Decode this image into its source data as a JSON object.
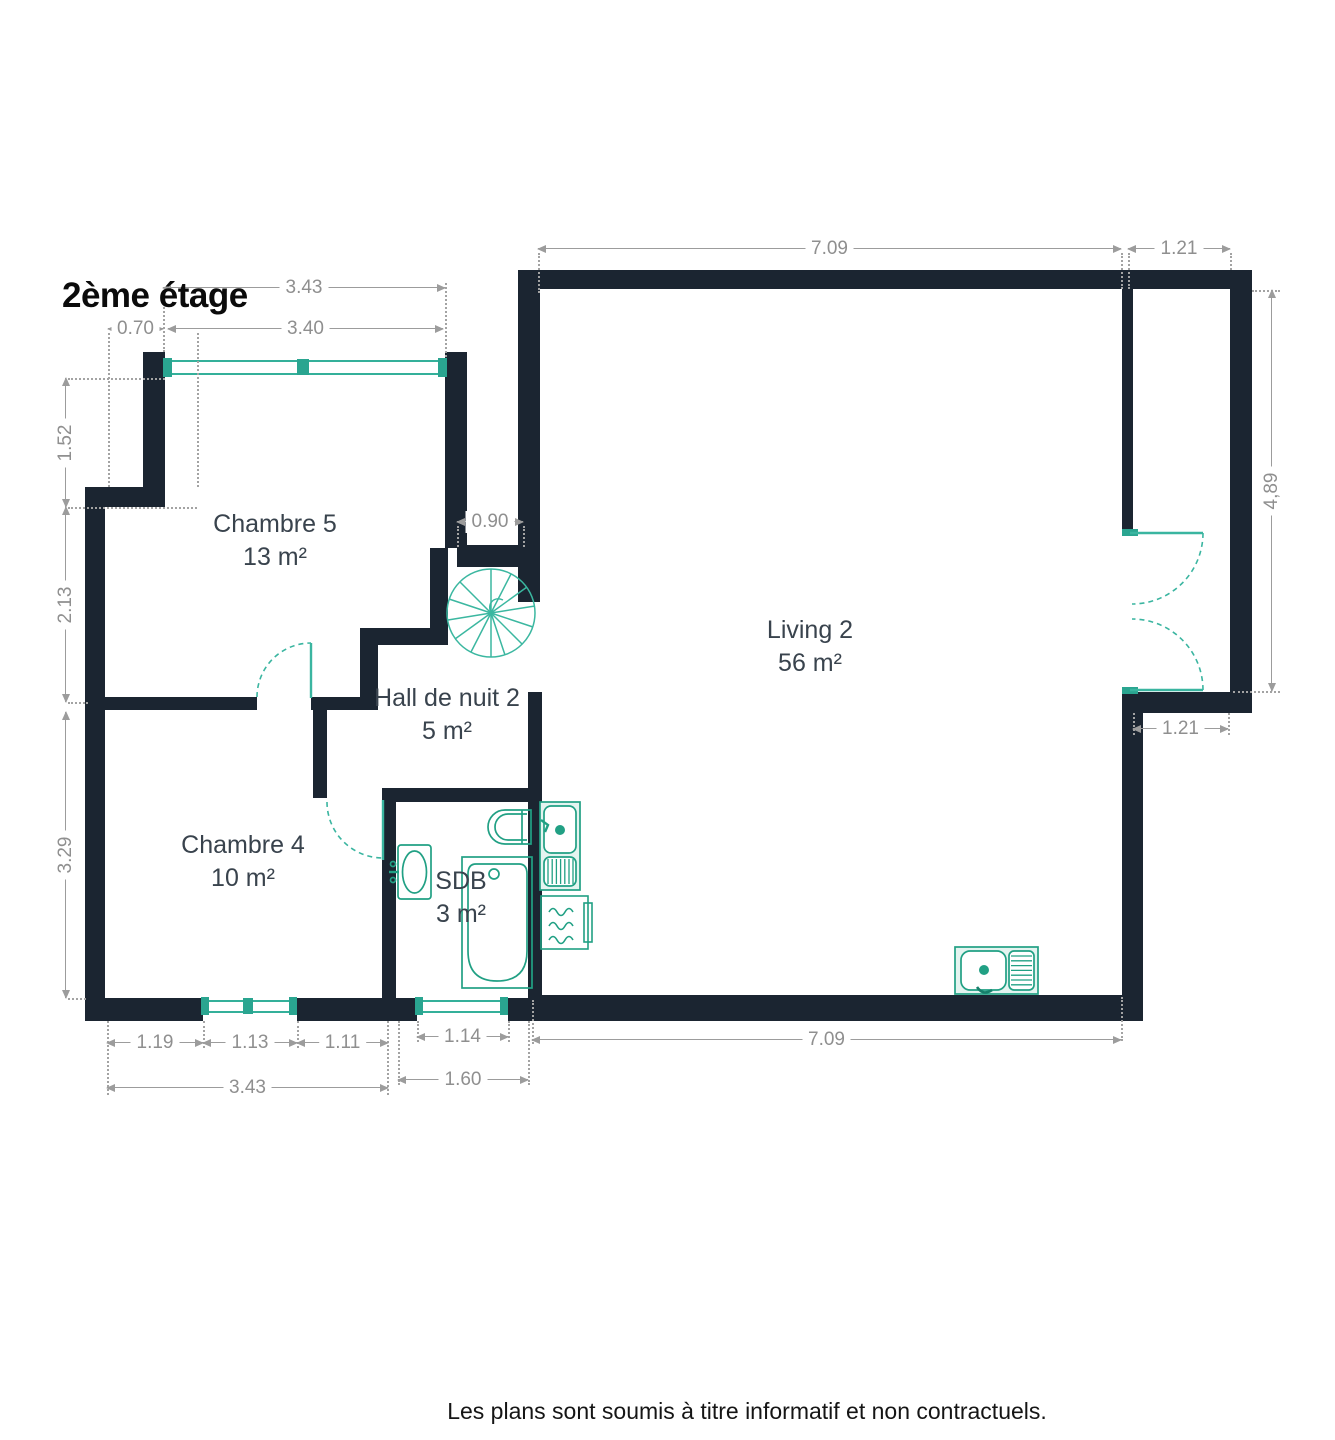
{
  "title": "2ème étage",
  "rooms": [
    {
      "name": "Chambre 5",
      "area": "13 m²"
    },
    {
      "name": "Living 2",
      "area": "56 m²"
    },
    {
      "name": "Hall de nuit 2",
      "area": "5 m²"
    },
    {
      "name": "Chambre 4",
      "area": "10 m²"
    },
    {
      "name": "SDB",
      "area": "3 m²"
    }
  ],
  "dims": {
    "c5_top_total": "3.43",
    "c5_top_offset": "0.70",
    "c5_top_window": "3.40",
    "left_upper": "1.52",
    "left_mid": "2.13",
    "left_lower": "3.29",
    "stair_width": "0.90",
    "living_top": "7.09",
    "balcony_top": "1.21",
    "living_right": "4,89",
    "balcony_inner": "1.21",
    "living_bottom": "7.09",
    "c4_seg1": "1.19",
    "c4_seg2": "1.13",
    "c4_seg3": "1.11",
    "c4_total": "3.43",
    "sdb_window": "1.14",
    "sdb_total": "1.60"
  },
  "disclaimer": "Les plans sont soumis à titre informatif et non contractuels.",
  "colors": {
    "wall": "#1b2531",
    "fixture": "#21a084",
    "window": "#34b09a",
    "dimension": "#8f8f8f",
    "room_label": "#39434d"
  }
}
